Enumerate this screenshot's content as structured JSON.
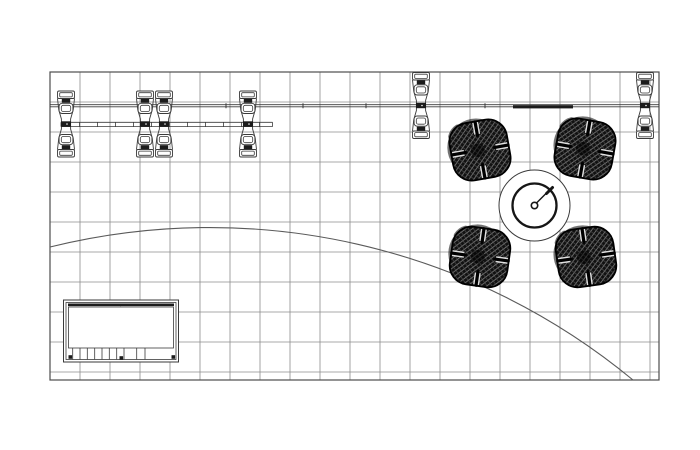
{
  "canvas": {
    "width": 700,
    "height": 450,
    "background": "#ffffff"
  },
  "drawing": {
    "type": "booth-floor-plan-top-view",
    "colors": {
      "grid_line": "#8c8c8c",
      "grid_border": "#4d4d4d",
      "line": "#3a3a3a",
      "dark_fill": "#1c1c1c",
      "arc": "#5a5a5a",
      "chair_fill": "#111111",
      "weave_hi": "#8a8a8a",
      "weave_lo": "#4a4a4a",
      "white": "#ffffff"
    },
    "grid": {
      "x": 50,
      "y": 72,
      "width": 609,
      "height": 308,
      "cell": 30,
      "v_lines": [
        80,
        110,
        140,
        170,
        200,
        230,
        260,
        290,
        320,
        350,
        380,
        410,
        440,
        470,
        500,
        530,
        560,
        590,
        620,
        650
      ],
      "h_lines": [
        102,
        132,
        162,
        192,
        222,
        252,
        282,
        312,
        342,
        372
      ]
    },
    "arc": {
      "x1": 50,
      "y1": 247,
      "x2": 633,
      "y2": 380,
      "radius": 664
    },
    "beam": {
      "x1": 50,
      "x2": 659,
      "y_top": 104.7,
      "y_bot": 106.8,
      "ticks": [
        226,
        303,
        366,
        485
      ],
      "tick_y1": 103.2,
      "tick_y2": 108.3,
      "header": {
        "x": 513,
        "y": 105.2,
        "width": 60,
        "height": 3.2
      }
    },
    "shelf_rail": {
      "x1": 61,
      "x2": 272.5,
      "y_top": 122.3,
      "y_bot": 126.6,
      "ticks": [
        79.5,
        97.5,
        115.5,
        133.5,
        151.5,
        169.5,
        187.5,
        205.5,
        223.5,
        241.5,
        259.5
      ]
    },
    "posts": [
      {
        "x": 66,
        "y": 124
      },
      {
        "x": 145,
        "y": 124
      },
      {
        "x": 164,
        "y": 124
      },
      {
        "x": 248,
        "y": 124
      },
      {
        "x": 421,
        "y": 105.5
      },
      {
        "x": 645,
        "y": 105.5
      }
    ],
    "chairs": [
      {
        "x": 480,
        "y": 150,
        "rot": -10
      },
      {
        "x": 585,
        "y": 149,
        "rot": 10
      },
      {
        "x": 480,
        "y": 257,
        "rot": 8
      },
      {
        "x": 586,
        "y": 257,
        "rot": -8
      }
    ],
    "table": {
      "cx": 534.5,
      "cy": 205.5,
      "r_outer": 35.5,
      "r_top": 22,
      "r_hub": 3.2,
      "hand": {
        "x1": 536.5,
        "y1": 203,
        "x2": 552,
        "y2": 187.5
      },
      "hand_tip": {
        "x1": 546.5,
        "y1": 193.5,
        "x2": 552.5,
        "y2": 187.5
      }
    },
    "counter": {
      "outer": {
        "x": 63.5,
        "y": 300,
        "width": 115,
        "height": 62
      },
      "mid": {
        "x": 66,
        "y": 302.5,
        "width": 110,
        "height": 57
      },
      "top_bar": {
        "x": 68,
        "y": 303.5,
        "width": 106,
        "height": 2.6
      },
      "inner": {
        "x": 68.5,
        "y": 307,
        "width": 105,
        "height": 41
      },
      "slat_y1": 348,
      "slat_y2": 359.5,
      "slats": [
        72.7,
        80,
        87.3,
        94.7,
        102,
        109.3,
        116.7,
        124,
        136.7,
        145
      ],
      "feet": [
        {
          "x": 68.5,
          "y": 355.2
        },
        {
          "x": 119.5,
          "y": 356.2
        },
        {
          "x": 171.5,
          "y": 355.2
        }
      ],
      "foot_size": 3.6,
      "center_mark": {
        "x": 120.5,
        "y": 303.8
      }
    }
  }
}
